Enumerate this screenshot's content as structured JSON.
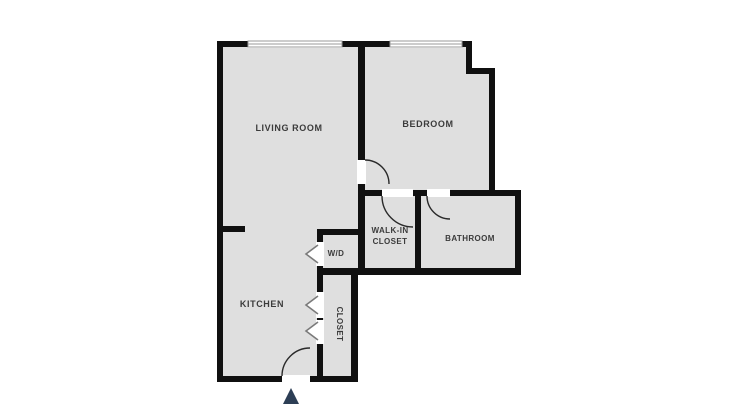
{
  "plan_title": "one-bedroom-apartment-floor-plan",
  "rooms": {
    "living_room": {
      "label": "LIVING ROOM"
    },
    "bedroom": {
      "label": "BEDROOM"
    },
    "walk_in_closet": {
      "label_line1": "WALK-IN",
      "label_line2": "CLOSET"
    },
    "bathroom": {
      "label": "BATHROOM"
    },
    "washer_dryer": {
      "label": "W/D"
    },
    "kitchen": {
      "label": "KITCHEN"
    },
    "closet": {
      "label": "CLOSET"
    }
  },
  "colors": {
    "background": "#ffffff",
    "floor": "#dfdfdf",
    "wall": "#101010",
    "door_swing": "#2a2a2a",
    "window_frame": "#9a9a9a",
    "bifold_door": "#7a7a7a",
    "room_label": "#3b3b3b",
    "entrance_arrow": "#2d3e55"
  }
}
